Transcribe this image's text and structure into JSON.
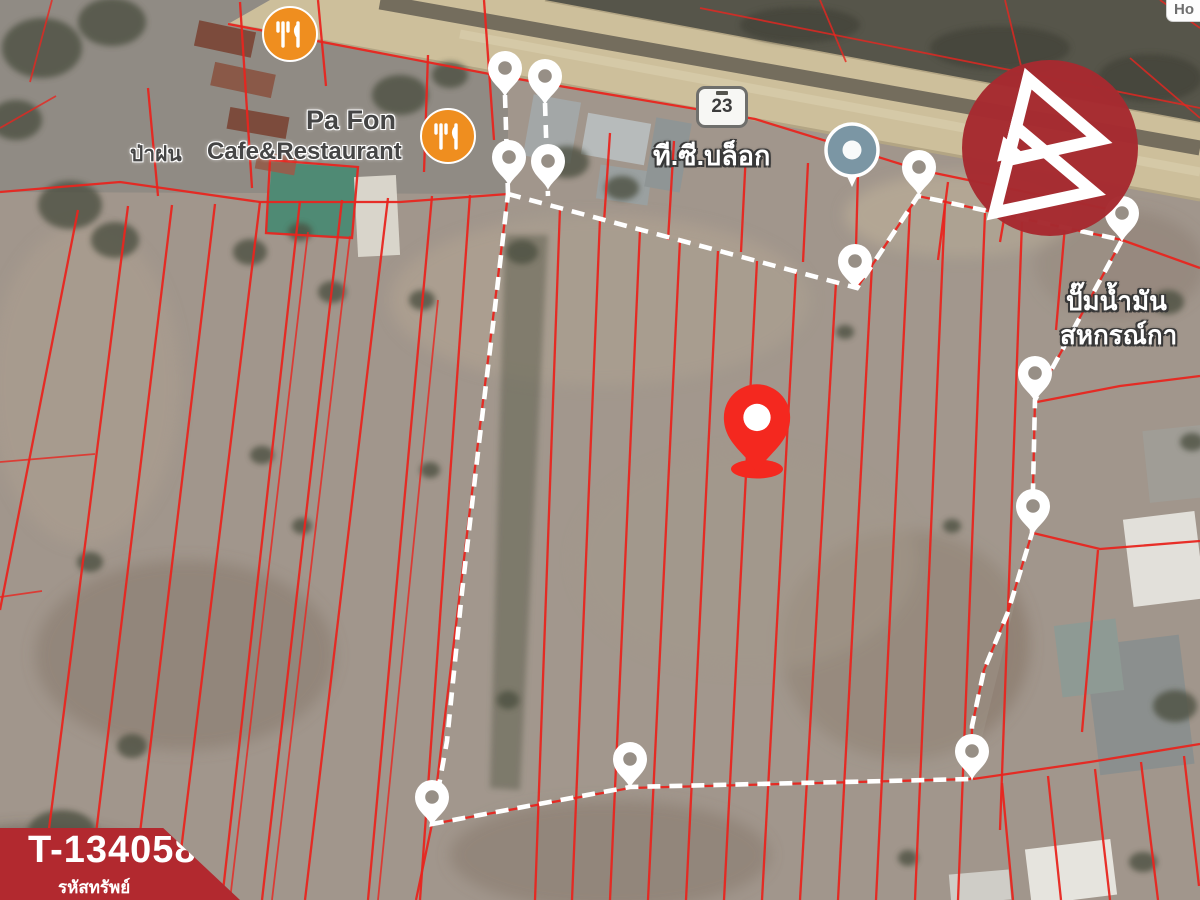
{
  "badge": {
    "code": "T-134058",
    "caption": "รหัสทรัพย์"
  },
  "labels": {
    "cafe_name_thai": "ป่าฝน",
    "cafe_name_en": "Pa Fon",
    "cafe_type": "Cafe&Restaurant",
    "route_number": "23",
    "factory_name": "ที.ซี.บล็อก",
    "gas_station_line1": "ปั๊มน้ำมัน",
    "gas_station_line2": "สหกรณ์กา",
    "partial_poi": "Ho"
  },
  "markers": {
    "boundary_vertex_pin_count": 12,
    "main_pin": "red-location-pin",
    "poi_icons": [
      "restaurant-icon",
      "restaurant-icon",
      "business-circle-icon",
      "brand-logo-icon"
    ]
  },
  "colors": {
    "parcel_line": "#e8251f",
    "boundary": "#ffffff",
    "pin_red": "#f4281f",
    "brand_red": "#a62b30",
    "banner_red": "#b2292f",
    "poi_orange": "#ef8e1f",
    "poi_blue": "#7b96a4",
    "road_tan": "#cdbf9b"
  }
}
